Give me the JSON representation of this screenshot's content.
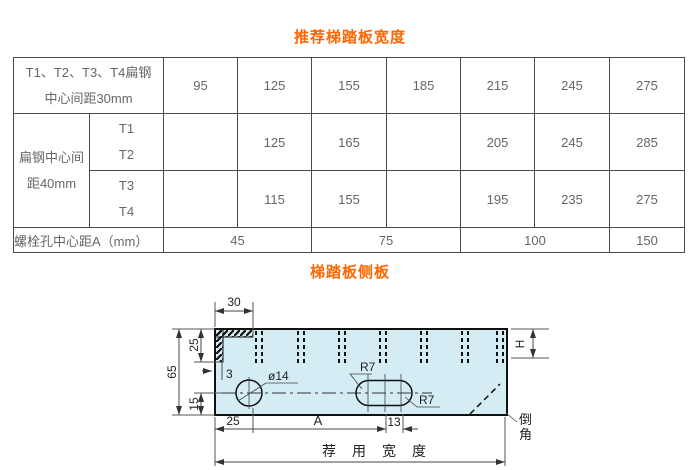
{
  "titles": {
    "table_title": "推荐梯踏板宽度",
    "drawing_title": "梯踏板侧板"
  },
  "colors": {
    "accent_orange": "#ff6600",
    "table_text": "#666666",
    "table_border": "#4a4a4a",
    "plate_fill": "#d4ecf4",
    "outline": "#111111"
  },
  "table": {
    "row_30mm": {
      "header_line1": "T1、T2、T3、T4扁钢",
      "header_line2": "中心间距30mm",
      "values": [
        "95",
        "125",
        "155",
        "185",
        "215",
        "245",
        "275"
      ]
    },
    "row_40mm": {
      "header_line1": "扁钢中心间",
      "header_line2": "距40mm"
    },
    "row_t1t2": {
      "sub_line1": "T1",
      "sub_line2": "T2",
      "values": [
        "",
        "125",
        "165",
        "",
        "205",
        "245",
        "285"
      ]
    },
    "row_t3t4": {
      "sub_line1": "T3",
      "sub_line2": "T4",
      "values": [
        "",
        "115",
        "155",
        "",
        "195",
        "235",
        "275"
      ]
    },
    "row_bolt": {
      "header": "螺栓孔中心距A（mm）",
      "values": [
        "45",
        "75",
        "100",
        "150"
      ]
    }
  },
  "drawing": {
    "dim_top_width": "30",
    "dim_upper_left": "25",
    "dim_total_height": "65",
    "dim_lower_left": "15",
    "dim_thickness": "3",
    "hole_label": "ø14",
    "slot_radius_top": "R7",
    "slot_radius_bottom": "R7",
    "dim_right_height": "H",
    "dim_edge_to_hole": "25",
    "dim_hole_to_slot": "A",
    "dim_slot_centers": "13",
    "bottom_width_label": "荐用宽度",
    "chamfer_label": "倒角"
  }
}
